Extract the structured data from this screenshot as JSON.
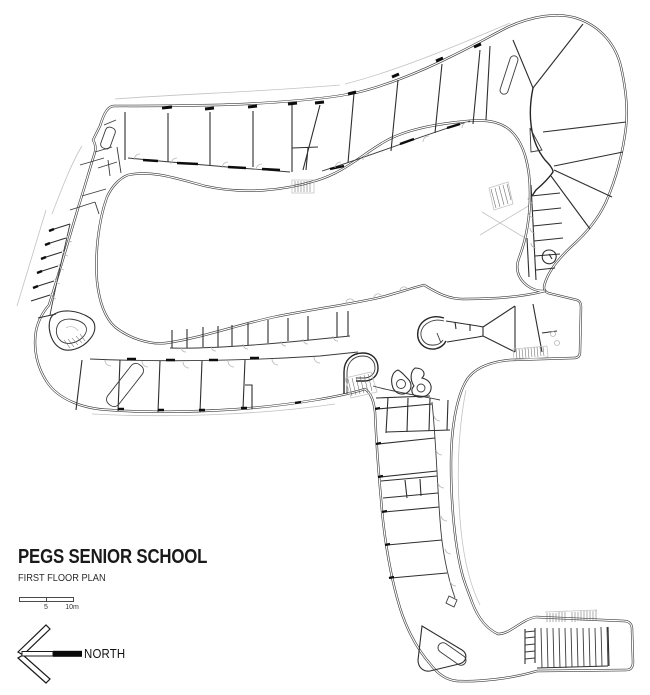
{
  "page": {
    "background": "#ffffff",
    "ink": "#2e2e2e",
    "light_ink": "#bdbdbd"
  },
  "title_block": {
    "title": "PEGS SENIOR SCHOOL",
    "subtitle": "FIRST FLOOR PLAN"
  },
  "scale_bar": {
    "mid_label": "5",
    "end_label": "10m"
  },
  "north_arrow": {
    "label": "NORTH"
  },
  "plan": {
    "kind": "architectural-floor-plan",
    "features": [
      "looped classroom wings around central courtyard",
      "fan-shaped rooms at north-east corner",
      "south-east wing with classrooms",
      "tiered lecture theatre at south-east",
      "stair cores and ramps hatched"
    ]
  }
}
